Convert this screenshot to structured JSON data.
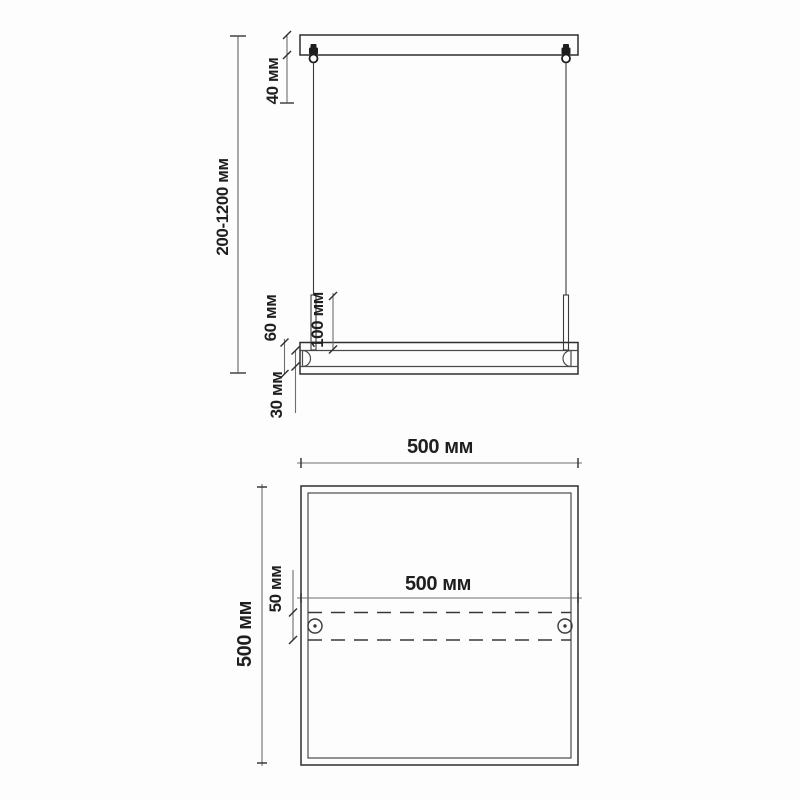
{
  "drawing": {
    "type": "pendant-light-fixture-dimension-drawing",
    "units": "мм"
  },
  "colors": {
    "background": "#fdfdfd",
    "drawing_line": "#2e2e2e",
    "dimension_line": "#6e6e6e",
    "text": "#1f1f1f"
  },
  "front_view": {
    "canopy_height": "40 мм",
    "suspension_range": "200-1200 мм",
    "fixture_height": "60 мм",
    "stem_length": "100 мм",
    "tube_height": "30 мм"
  },
  "top_view": {
    "overall_width": "500 мм",
    "bar_length": "500 мм",
    "overall_depth": "500 мм",
    "bar_width": "50 мм"
  }
}
